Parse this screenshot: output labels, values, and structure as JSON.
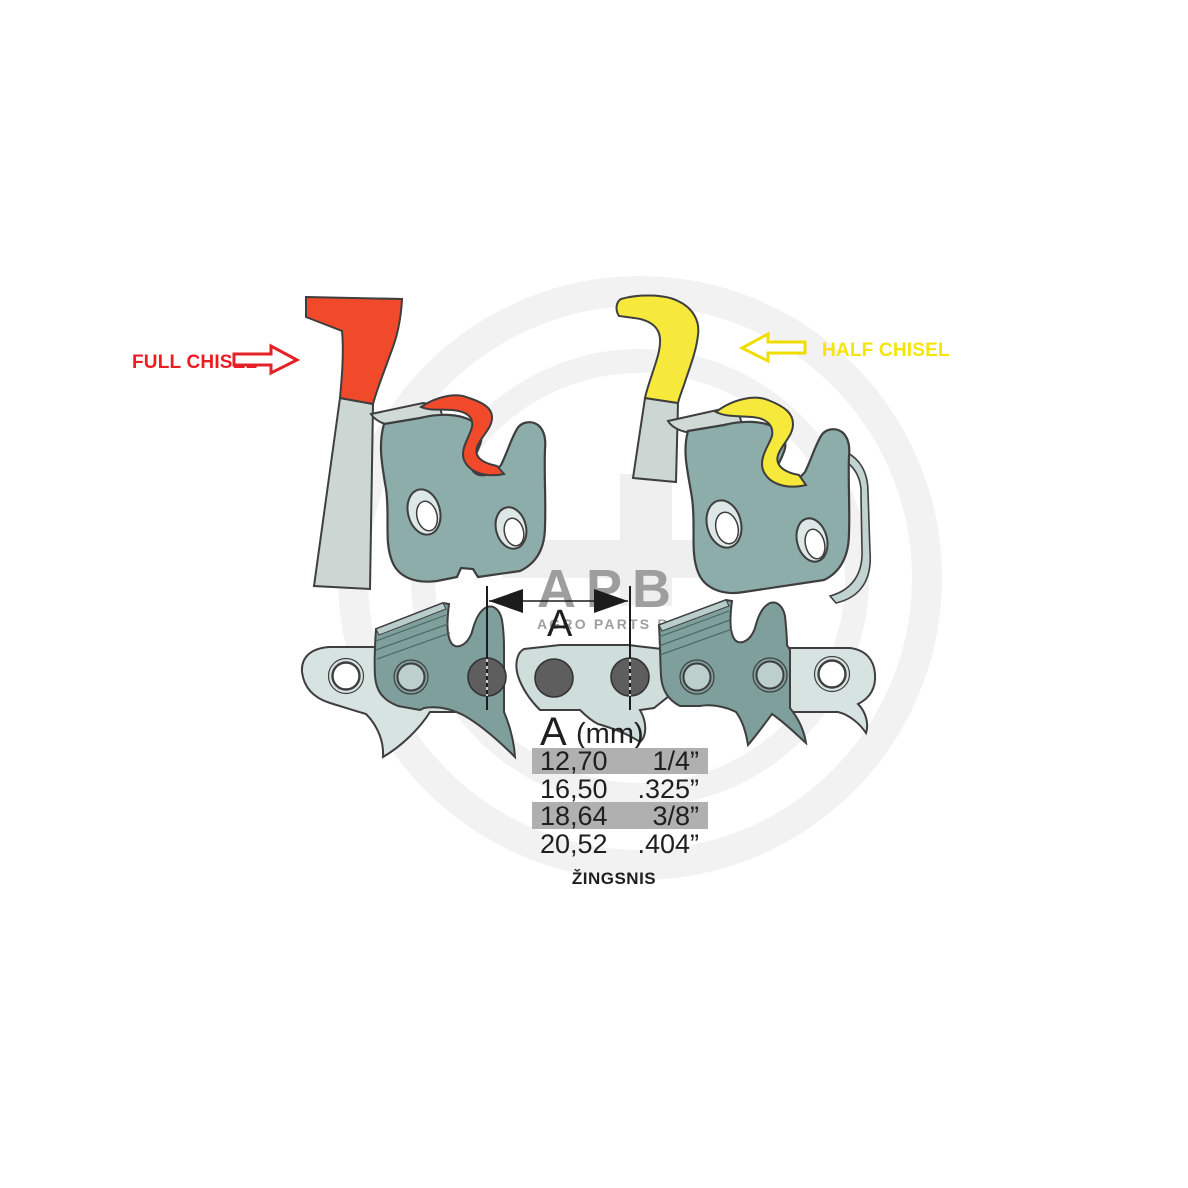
{
  "labels": {
    "full_chisel": "FULL CHISEL",
    "half_chisel": "HALF CHISEL"
  },
  "dimension": {
    "letter": "A"
  },
  "watermark": {
    "logo": "APB",
    "subtitle": "AGRO PARTS BALTIJA"
  },
  "pitch_table": {
    "header_letter": "A",
    "header_unit": "(mm)",
    "rows": [
      {
        "mm": "12,70",
        "inch": "1/4”",
        "highlighted": true
      },
      {
        "mm": "16,50",
        "inch": ".325”",
        "highlighted": false
      },
      {
        "mm": "18,64",
        "inch": "3/8”",
        "highlighted": true
      },
      {
        "mm": "20,52",
        "inch": ".404”",
        "highlighted": false
      }
    ],
    "caption": "ŽINGSNIS"
  },
  "colors": {
    "full_chisel_red": "#f04a2b",
    "full_chisel_text": "#ed1c24",
    "half_chisel_yellow": "#f6e93b",
    "half_chisel_text": "#f6e40b",
    "cutter_teal": "#8cada9",
    "chain_cutter_teal": "#7f9f9c",
    "strap_light": "#d7e3e0",
    "strap_mid": "#cfdedb",
    "rivet_dark": "#5e5e5e",
    "table_highlight": "#b0b0b0",
    "watermark_gray": "#f2f2f2",
    "watermark_text": "#9e9e9e",
    "ink": "#1f1f1f"
  }
}
